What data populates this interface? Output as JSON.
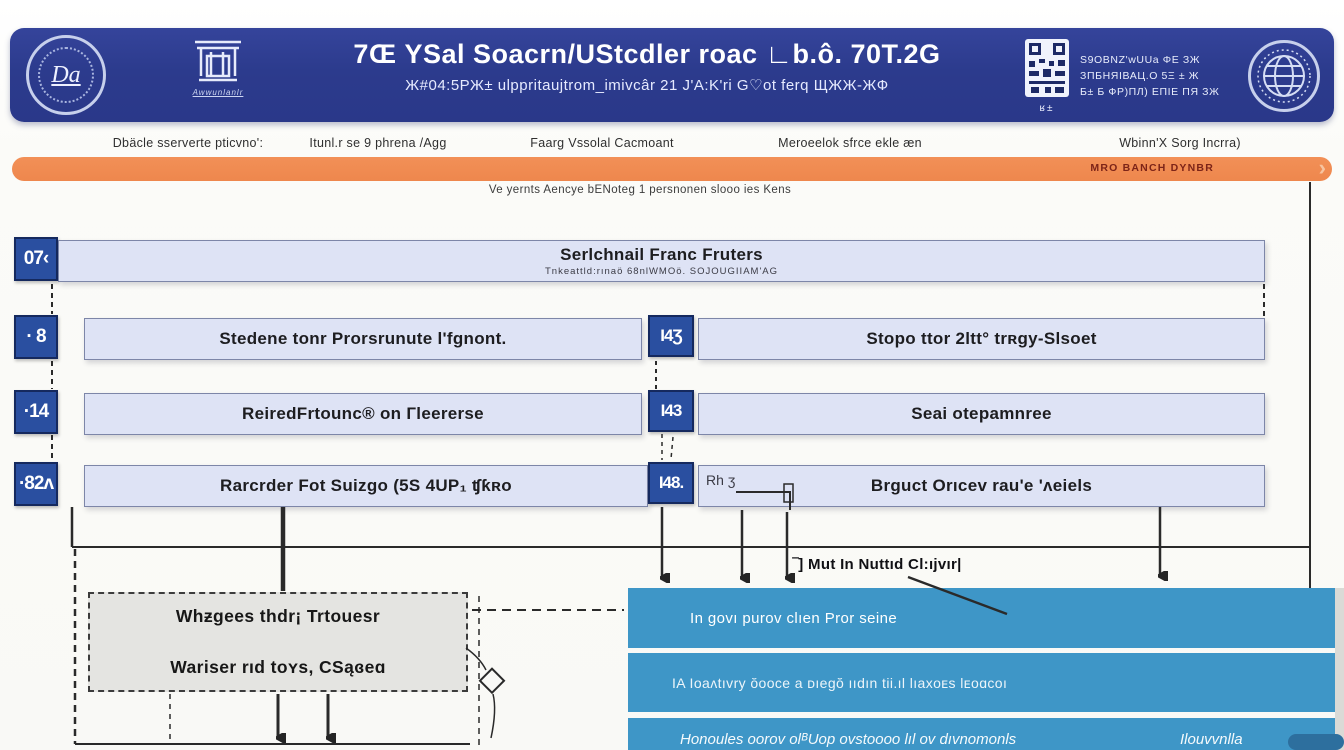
{
  "colors": {
    "header_navy": "#2c3b8d",
    "banner_orange": "#ee874d",
    "bar_lavender": "#dee3f5",
    "badge_blue": "#2a4fa0",
    "panel_blue": "#3e96c7",
    "box_gray": "#e4e4e1"
  },
  "header": {
    "title": "7Œ ΥSal Soacrn/UStcdler roac ∟b.ô. 70T.2G",
    "subtitle": "Ж#04:5РЖ± ulppritaujtrom_imivcâr 21 J'A:K'ri G♡ot ferq ЩЖЖ-ЖФ",
    "seal_label": "Da",
    "emblem_caption": "Awwunlanlr",
    "qr_caption": "ʁ±",
    "info_lines": [
      "S9OBNZ'wUUa ΦΕ ЗЖ",
      "ЗПБНЯІВАЦ.О 5Ξ ± Ж",
      "Б± Б ФР)ПЛ) ЕПІЕ ПЯ ЗЖ"
    ]
  },
  "menu": {
    "items": [
      "Dbäcle sserverte pticvno':",
      "Itunl.r se 9 phrena /Agg",
      "Faarg Vssolal Cacmoant",
      "Meroeelok sfrce ekle æn",
      "Wbinn'X Sorg Incrra)"
    ]
  },
  "banner": {
    "right_text": "MRO BANCH DYNBR",
    "chevron": "›"
  },
  "intro": {
    "text": "Ve yernts Aencye bENoteg 1 persnonen slooo ies Kens"
  },
  "flow": {
    "row1": {
      "badge": "07‹",
      "title": "Serlchnail Franc Fruters",
      "subtitle": "Tnkeattld:rınaö 68nlWMOö. SOJOUGIIAM'AG"
    },
    "row2": {
      "badge": "· 8",
      "title": "Stedene tonr Prorsrunute l'fgnont.",
      "badge2": "I4Ʒ",
      "title2": "Stopo ttor 2ltt° trʀgy-Slsoet"
    },
    "row3": {
      "badge": "·14",
      "title": "ReiredFrtounc® on Гleererse",
      "badge2": "I43",
      "title2": "Seai otepamnree"
    },
    "row4": {
      "badge": "·82ʌ",
      "title": "Rarcrder Fot Suizgo (5S 4UP₁ ʧƙʀo",
      "badge2": "I48.",
      "note": "Rh ʒ",
      "title2": "Brguct Orıcev rau'e 'ʌeiels"
    }
  },
  "gray_box": {
    "line1": "Whƶgees thdr¡ Trtouesr",
    "line2": "Wariser rıd toʏs, CSąɞeɑ"
  },
  "blue_panel": {
    "label": "‾] Mut In Nuttıd Cl:ıjvır|",
    "rows": [
      "In ɡovı purov clıen Pror seine",
      "IA  Ioaʌtıvry ŏooce a ᴅıegŏ ııdın tii.ıl lıaxoᴇs lᴇᴏɑᴄᴏı",
      "Honoules oorov olᴮUop ovstoooo lıl ov dıvnomonls"
    ],
    "row3_right": "Ilouvvnlla"
  }
}
